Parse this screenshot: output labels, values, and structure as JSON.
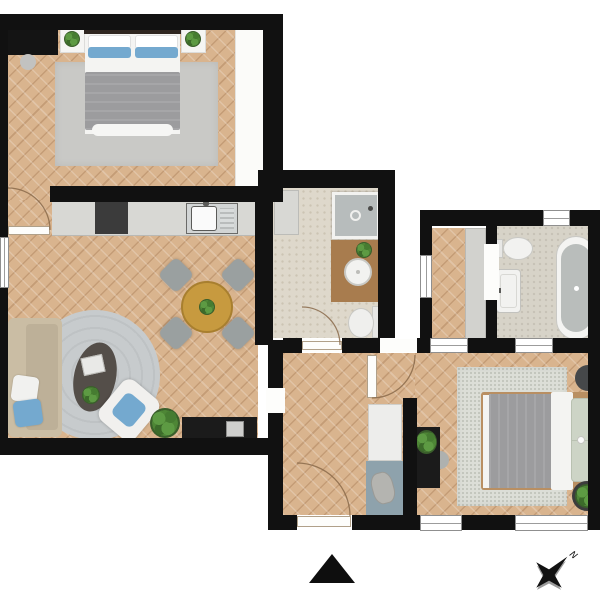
{
  "page": {
    "type": "apartment-floor-plan",
    "background": "#ffffff"
  },
  "compass": {
    "north_label": "N"
  },
  "markers": {
    "triangle": "solid-black-up-triangle",
    "compass_rose": "four-point-star-with-north-label"
  },
  "palette": {
    "wall": "#111111",
    "wood": "#d9b48e",
    "rug": "#c9c9c6",
    "rugspeckle": "#dcded7",
    "counter": "#d8d8d4",
    "stove": "#3b3b3b",
    "table": "#c79a3f",
    "chair": "#9aa0a0",
    "sofa": "#cabda4",
    "sofacushion": "#bdb098",
    "pillowblue": "#74a9cf",
    "blanket": "#9c9c9e",
    "sheet": "#f4f4f2",
    "bathfloor": "#ded8cb",
    "bathfloor2": "#d7d3c8",
    "shower": "#b7bcbc",
    "vanity": "#a87c4e",
    "fixture": "#f2f2f0",
    "tub": "#b9bdbb",
    "closet": "#d2d2ce",
    "cabinet": "#ededeb",
    "mat": "#8ea2ac",
    "blackfurniture": "#1b1b1b",
    "doorarc": "#8a6a4a"
  },
  "rooms": [
    {
      "name": "bedroom-1",
      "floor": "herringbone-wood",
      "furniture": [
        "wardrobe",
        "stool",
        "nightstand-left",
        "plant-left",
        "double-bed",
        "blue-pillows",
        "gray-duvet",
        "area-rug",
        "nightstand-right",
        "plant-right",
        "built-in-closet"
      ]
    },
    {
      "name": "living-room-kitchen",
      "floor": "herringbone-wood",
      "furniture": [
        "kitchen-counter",
        "cooktop",
        "kitchen-sink",
        "round-dining-table",
        "dining-chair-nw",
        "dining-chair-ne",
        "dining-chair-sw",
        "dining-chair-se",
        "table-plant",
        "sofa",
        "sofa-pillows",
        "round-rug",
        "coffee-table",
        "magazines",
        "lounge-chair",
        "floor-plant",
        "tv-stand",
        "tv"
      ]
    },
    {
      "name": "bathroom-1",
      "floor": "stone-tile",
      "furniture": [
        "shower",
        "side-cabinet",
        "wood-vanity",
        "round-washbasin",
        "plant",
        "toilet"
      ]
    },
    {
      "name": "entry-hallway",
      "floor": "herringbone-wood",
      "furniture": [
        "tall-cabinet",
        "bench-mat",
        "bag"
      ]
    },
    {
      "name": "corridor",
      "floor": "herringbone-wood",
      "furniture": [
        "closet-strip"
      ]
    },
    {
      "name": "bathroom-2",
      "floor": "stone-tile",
      "furniture": [
        "toilet",
        "washbasin",
        "freestanding-bathtub"
      ]
    },
    {
      "name": "bedroom-2",
      "floor": "herringbone-wood",
      "furniture": [
        "double-bed",
        "sage-pillows",
        "area-rug",
        "desk",
        "desk-plant",
        "desk-chair",
        "pouf",
        "floor-plant"
      ]
    }
  ],
  "openings": {
    "doors": [
      "bedroom-1-door",
      "bathroom-1-door",
      "corridor-door",
      "entry-door"
    ],
    "windows": [
      "living-room-window",
      "corridor-window",
      "bathroom-2-window",
      "bedroom-2-top-window-1",
      "bedroom-2-top-window-2",
      "bedroom-2-bottom-window-1",
      "bedroom-2-bottom-window-2"
    ]
  }
}
